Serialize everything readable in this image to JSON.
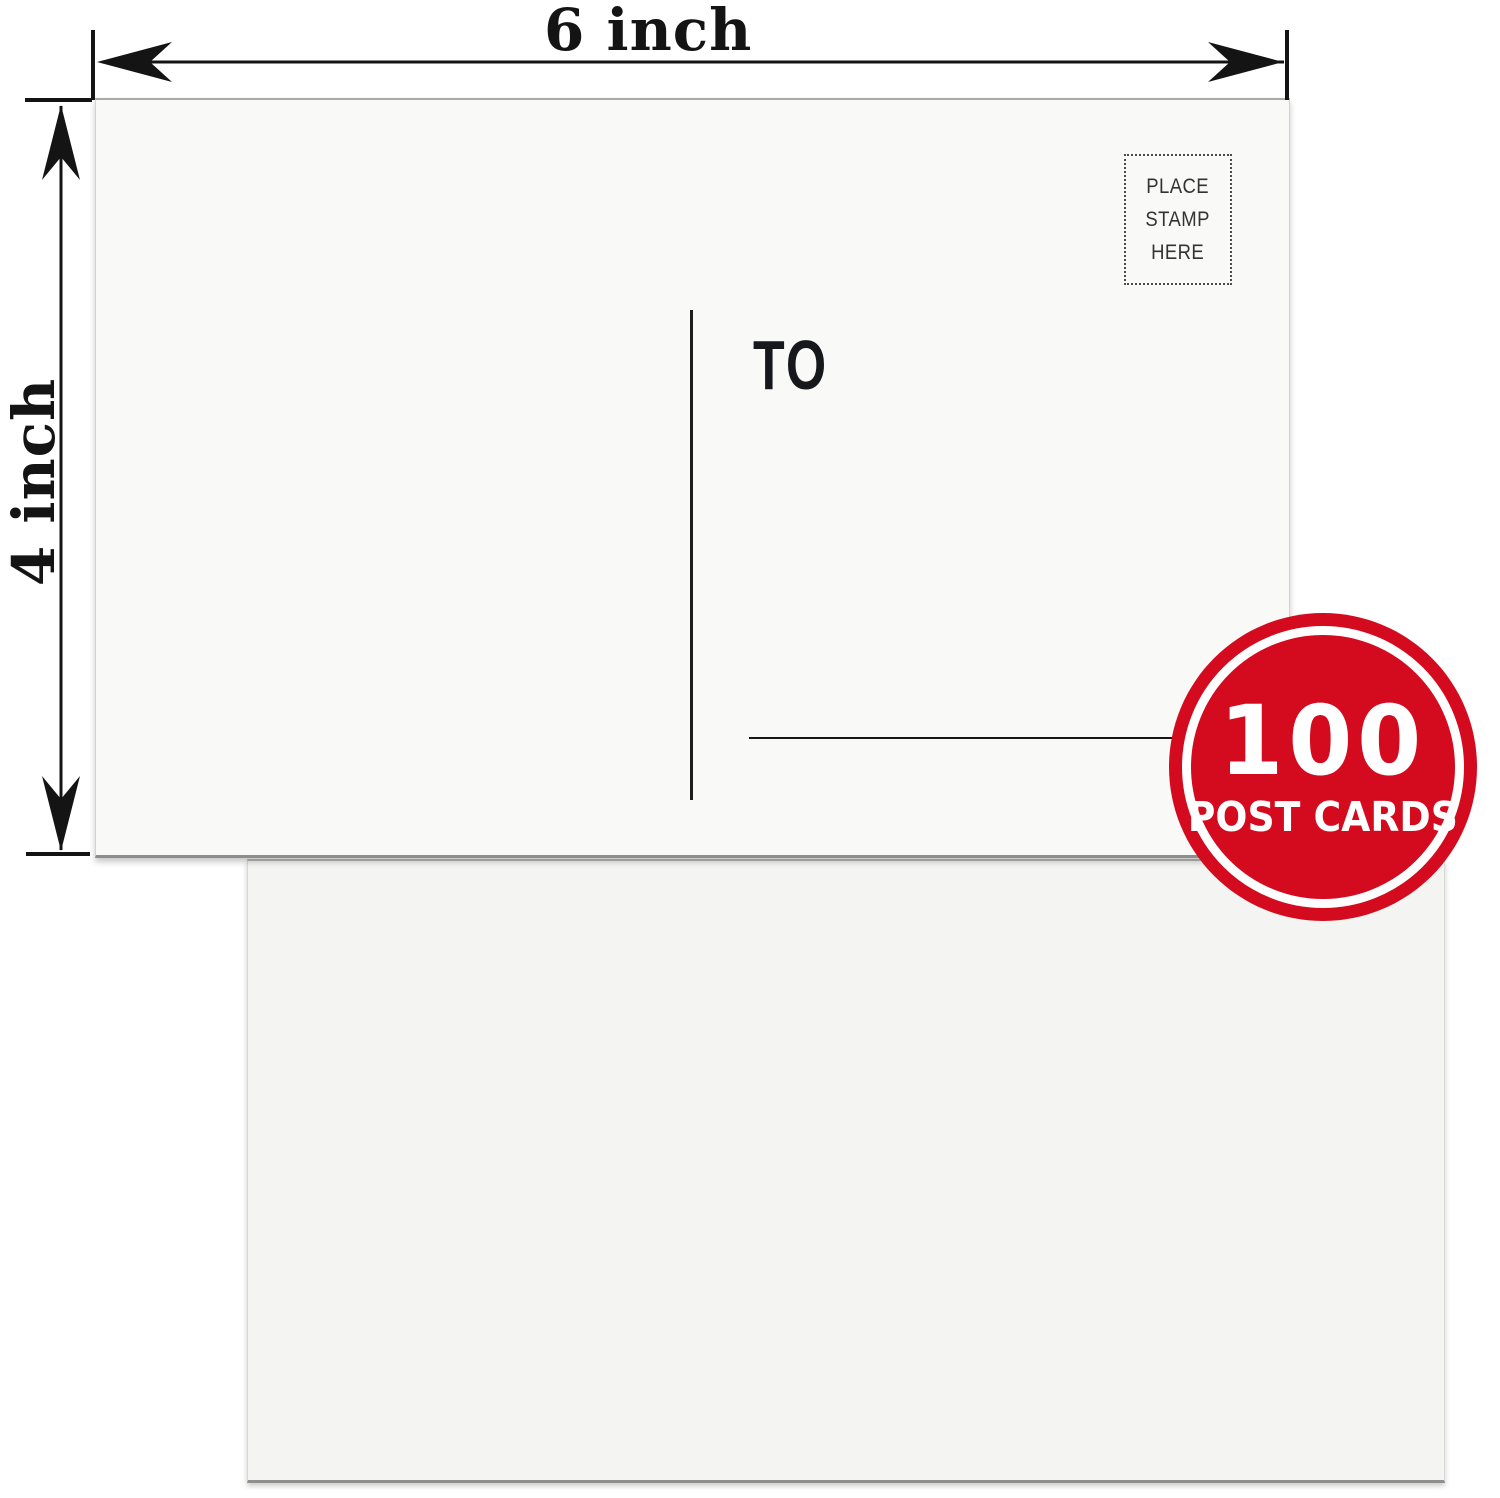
{
  "annotation": {
    "width_label": "6 inch",
    "height_label": "4 inch"
  },
  "postcard_front": {
    "stamp_text": "PLACE\nSTAMP\nHERE",
    "to_label": "TO",
    "address_line_count": 4
  },
  "badge": {
    "count": "100",
    "label": "POST CARDS",
    "color": "#d40a1e",
    "text_color": "#ffffff"
  },
  "colors": {
    "ink": "#141414",
    "card_front_bg": "#f9f9f7",
    "card_back_bg": "#f4f4f2",
    "background": "#ffffff"
  }
}
